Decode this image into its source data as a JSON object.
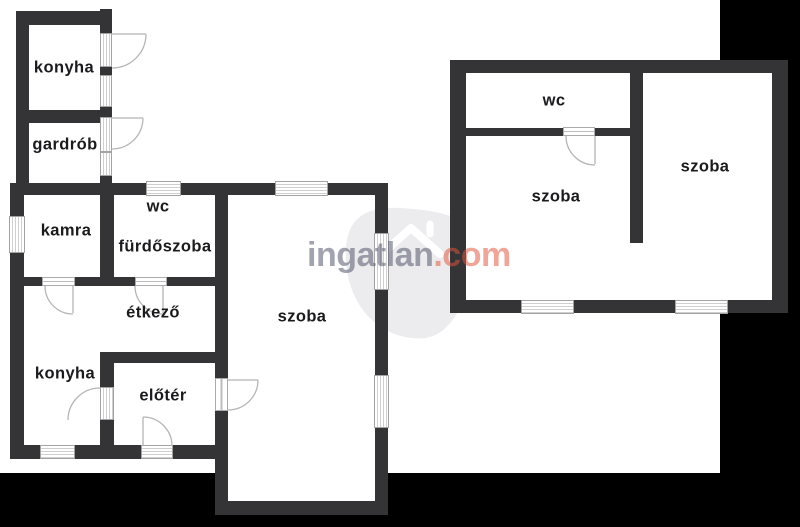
{
  "canvas": {
    "width": 800,
    "height": 527,
    "background": "#000000",
    "paper_color": "#ffffff"
  },
  "palette": {
    "wall": "#343437",
    "label_text": "#1b1b1d",
    "window_frame": "#a3a3a3",
    "window_stripe": "#cfcfcf",
    "door_arc": "#b5b5b5",
    "logo_watermark_fill": "#ececef"
  },
  "watermark": {
    "brand_gray": "ingatlan",
    "brand_accent": ".com",
    "gray_color": "rgba(75,78,100,0.52)",
    "accent_color": "rgba(224,84,60,0.52)"
  },
  "rooms": {
    "konyha_top": "konyha",
    "gardrob": "gardrób",
    "kamra": "kamra",
    "wc_left": "wc",
    "furdoszoba": "fürdőszoba",
    "etkezo": "étkező",
    "konyha_bottom": "konyha",
    "eloter": "előtér",
    "szoba_main": "szoba",
    "wc_right": "wc",
    "szoba_right_left": "szoba",
    "szoba_right_right": "szoba"
  }
}
